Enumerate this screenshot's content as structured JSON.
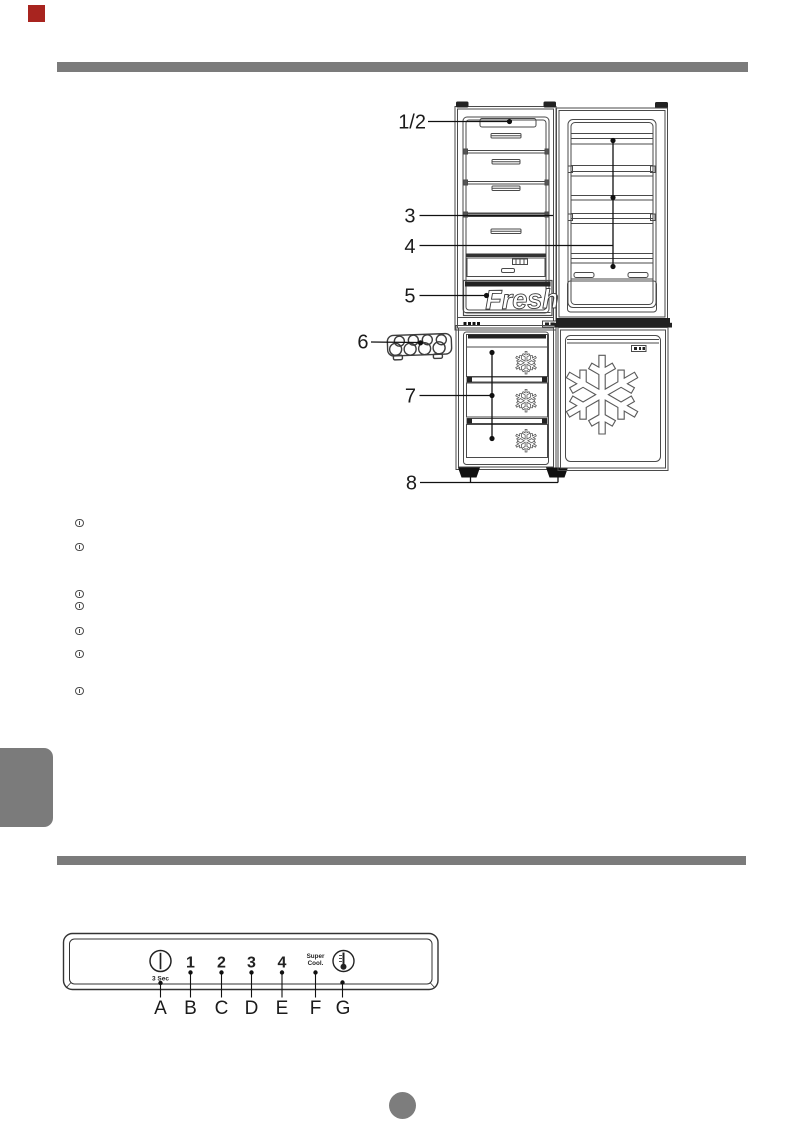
{
  "page": {
    "type": "appliance-manual-page",
    "corner_mark_color": "#a8241f",
    "divider_bar_color": "#7b7b7b",
    "side_tab_color": "#7b7b7b",
    "page_number_dot_color": "#7d7d7d"
  },
  "diagram": {
    "name": "refrigerator-freezer-parts-diagram",
    "callouts": [
      "1/2",
      "3",
      "4",
      "5",
      "6",
      "7",
      "8"
    ],
    "fresh_drawer_label": "Fresh",
    "icons": [
      "egg-tray-icon",
      "snowflake-icon",
      "snowflake-icon",
      "snowflake-icon",
      "snowflake-large-icon"
    ]
  },
  "notes": {
    "bullet_count": 7,
    "bullet_glyph": "circled-digit-icon"
  },
  "control_panel": {
    "power_hold_label": "3 Sec",
    "setting_labels": [
      "1",
      "2",
      "3",
      "4"
    ],
    "super_cool_line1": "Super",
    "super_cool_line2": "Cool.",
    "icons": [
      "power-icon",
      "thermometer-icon"
    ],
    "point_labels": [
      "A",
      "B",
      "C",
      "D",
      "E",
      "F",
      "G"
    ]
  }
}
